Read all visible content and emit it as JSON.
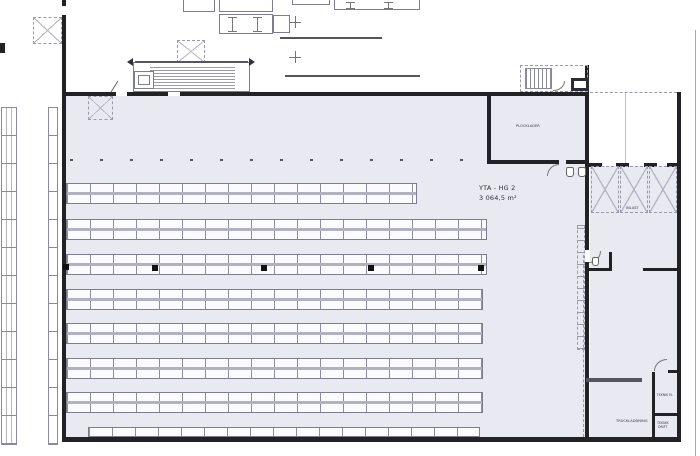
{
  "labels": {
    "area_name": "YTA - HG 2",
    "area_size": "3 064,5 m²",
    "plocklager": "PLOCKLAGER",
    "inlast": "INLAST",
    "truckladdning": "TRUCKLADDNING",
    "teknik_el": "TEKNIK EL",
    "teknik_drift": "TEKNIK DRIFT"
  },
  "colors": {
    "hall_fill": "#e9e9f2",
    "wall": "#212126",
    "rack_line": "#8d8da0",
    "rack_fill": "#fbfbfd",
    "dashed": "#9a9aab"
  },
  "floor_plan": {
    "bay_width": 23,
    "rack_rows": [
      {
        "x": 66,
        "y": 183,
        "w": 351,
        "type": "double"
      },
      {
        "x": 66,
        "y": 219,
        "w": 421,
        "type": "double"
      },
      {
        "x": 66,
        "y": 254,
        "w": 421,
        "type": "double"
      },
      {
        "x": 66,
        "y": 289,
        "w": 417,
        "type": "double"
      },
      {
        "x": 66,
        "y": 323,
        "w": 417,
        "type": "double"
      },
      {
        "x": 66,
        "y": 358,
        "w": 417,
        "type": "double"
      },
      {
        "x": 66,
        "y": 392,
        "w": 417,
        "type": "double"
      },
      {
        "x": 88,
        "y": 427,
        "w": 392,
        "type": "single"
      }
    ],
    "columns": [
      [
        63,
        264
      ],
      [
        152,
        265
      ],
      [
        261,
        265
      ],
      [
        368,
        265
      ],
      [
        478,
        265
      ]
    ],
    "dock_levelers_right": 3,
    "dock_doors_top": 2
  }
}
